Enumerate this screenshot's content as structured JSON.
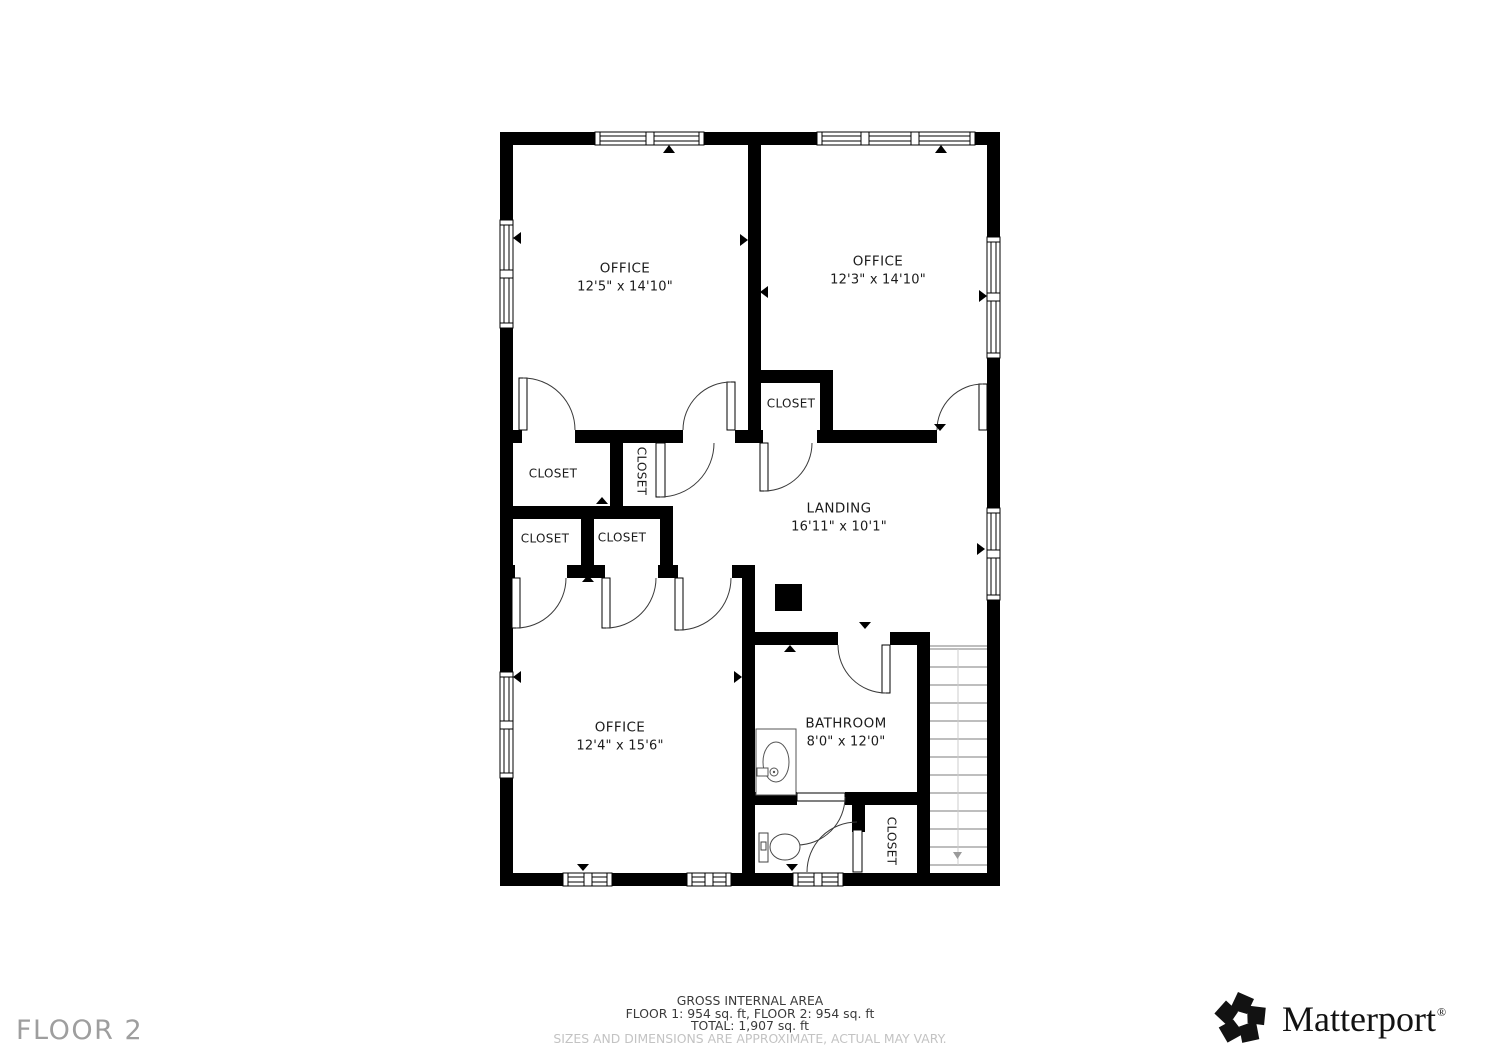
{
  "floor": {
    "label": "FLOOR 2"
  },
  "rooms": {
    "office_top_left": {
      "name": "OFFICE",
      "dims": "12'5\" x 14'10\""
    },
    "office_top_right": {
      "name": "OFFICE",
      "dims": "12'3\" x 14'10\""
    },
    "office_bottom": {
      "name": "OFFICE",
      "dims": "12'4\" x 15'6\""
    },
    "landing": {
      "name": "LANDING",
      "dims": "16'11\" x 10'1\""
    },
    "bathroom": {
      "name": "BATHROOM",
      "dims": "8'0\" x 12'0\""
    },
    "closet_between_offices": {
      "name": "CLOSET"
    },
    "closet_hall_large": {
      "name": "CLOSET"
    },
    "closet_hall_vertical": {
      "name": "CLOSET"
    },
    "closet_hall_lower_left": {
      "name": "CLOSET"
    },
    "closet_hall_lower_right": {
      "name": "CLOSET"
    },
    "closet_bathroom": {
      "name": "CLOSET"
    }
  },
  "footer": {
    "title": "GROSS INTERNAL AREA",
    "floors": "FLOOR 1: 954 sq. ft, FLOOR 2: 954 sq. ft",
    "total": "TOTAL: 1,907 sq. ft",
    "disclaimer": "SIZES AND DIMENSIONS ARE APPROXIMATE, ACTUAL MAY VARY."
  },
  "brand": {
    "wordmark": "Matterport",
    "registered": "®"
  },
  "colors": {
    "wall": "#000000",
    "label": "#1b1b1b",
    "muted": "#9e9e9e",
    "disclaimer": "#c3c3c3"
  }
}
